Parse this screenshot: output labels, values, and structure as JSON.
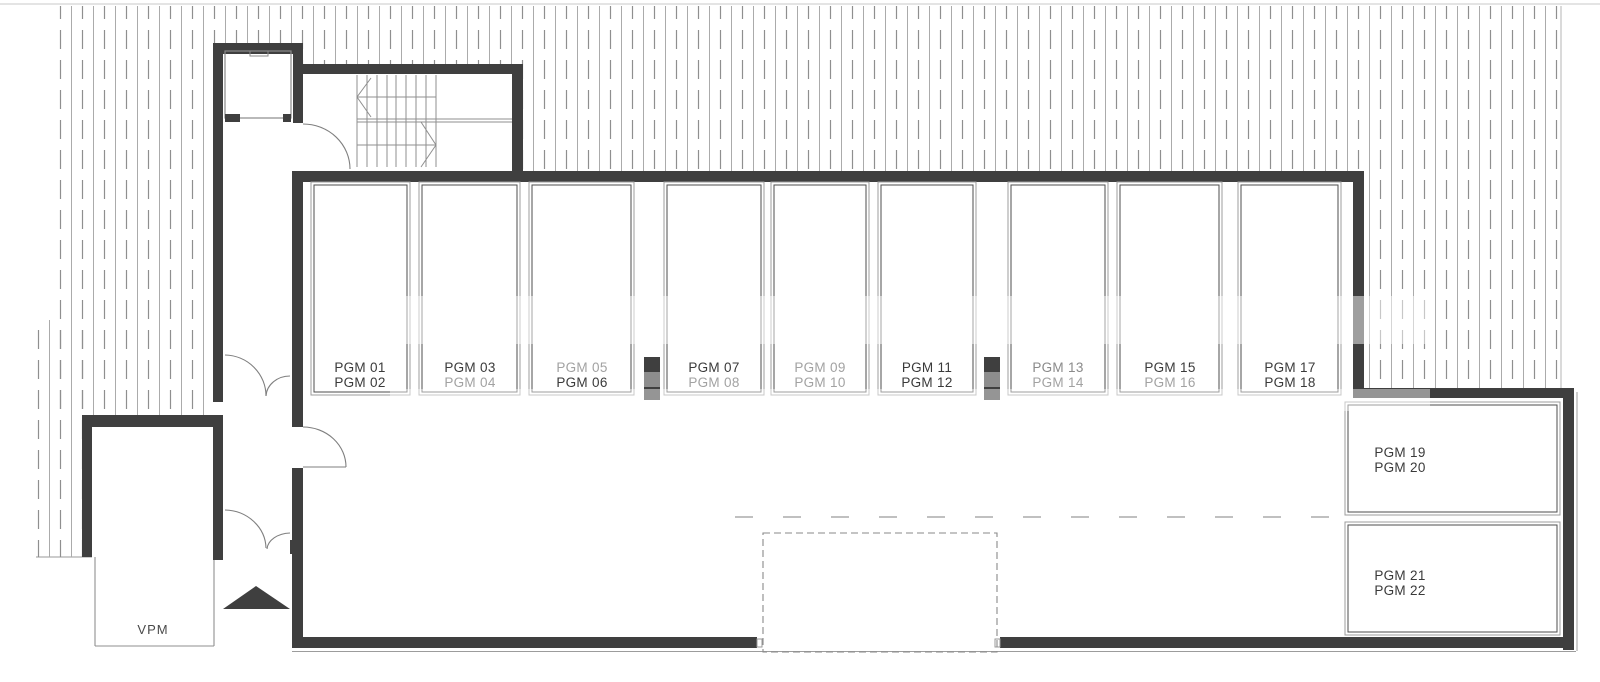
{
  "plan": {
    "type": "parking-garage-floor-plan",
    "vpm_label": "VPM",
    "colors": {
      "wall": "#3f3f3f",
      "thin_line": "#8f8f8f",
      "hatch_solid": "#ababab",
      "hatch_dashed": "#8f8f8f",
      "stall_outer": "#9c9c9c",
      "stall_inner": "#4d4d4d",
      "label_dark": "#3a3a3a",
      "label_muted": "#a2a2a2",
      "pillar_gray": "#8d8d8d",
      "vpm": "#4a4a4a",
      "dashed_outline": "#8a8a8a"
    },
    "stalls": [
      {
        "line1": "PGM 01",
        "line1_color": "#3a3a3a",
        "line2": "PGM 02",
        "line2_color": "#3a3a3a"
      },
      {
        "line1": "PGM 03",
        "line1_color": "#3a3a3a",
        "line2": "PGM 04",
        "line2_color": "#a2a2a2"
      },
      {
        "line1": "PGM 05",
        "line1_color": "#a2a2a2",
        "line2": "PGM 06",
        "line2_color": "#3a3a3a"
      },
      {
        "line1": "PGM 07",
        "line1_color": "#3a3a3a",
        "line2": "PGM 08",
        "line2_color": "#a2a2a2"
      },
      {
        "line1": "PGM 09",
        "line1_color": "#a2a2a2",
        "line2": "PGM 10",
        "line2_color": "#a2a2a2"
      },
      {
        "line1": "PGM 11",
        "line1_color": "#3a3a3a",
        "line2": "PGM 12",
        "line2_color": "#3a3a3a"
      },
      {
        "line1": "PGM 13",
        "line1_color": "#8a8a8a",
        "line2": "PGM 14",
        "line2_color": "#a2a2a2"
      },
      {
        "line1": "PGM 15",
        "line1_color": "#3a3a3a",
        "line2": "PGM 16",
        "line2_color": "#a2a2a2"
      },
      {
        "line1": "PGM 17",
        "line1_color": "#3a3a3a",
        "line2": "PGM 18",
        "line2_color": "#3a3a3a"
      }
    ],
    "right_stalls": [
      {
        "line1": "PGM 19",
        "line1_color": "#3a3a3a",
        "line2": "PGM 20",
        "line2_color": "#3a3a3a"
      },
      {
        "line1": "PGM 21",
        "line1_color": "#3a3a3a",
        "line2": "PGM 22",
        "line2_color": "#3a3a3a"
      }
    ]
  }
}
